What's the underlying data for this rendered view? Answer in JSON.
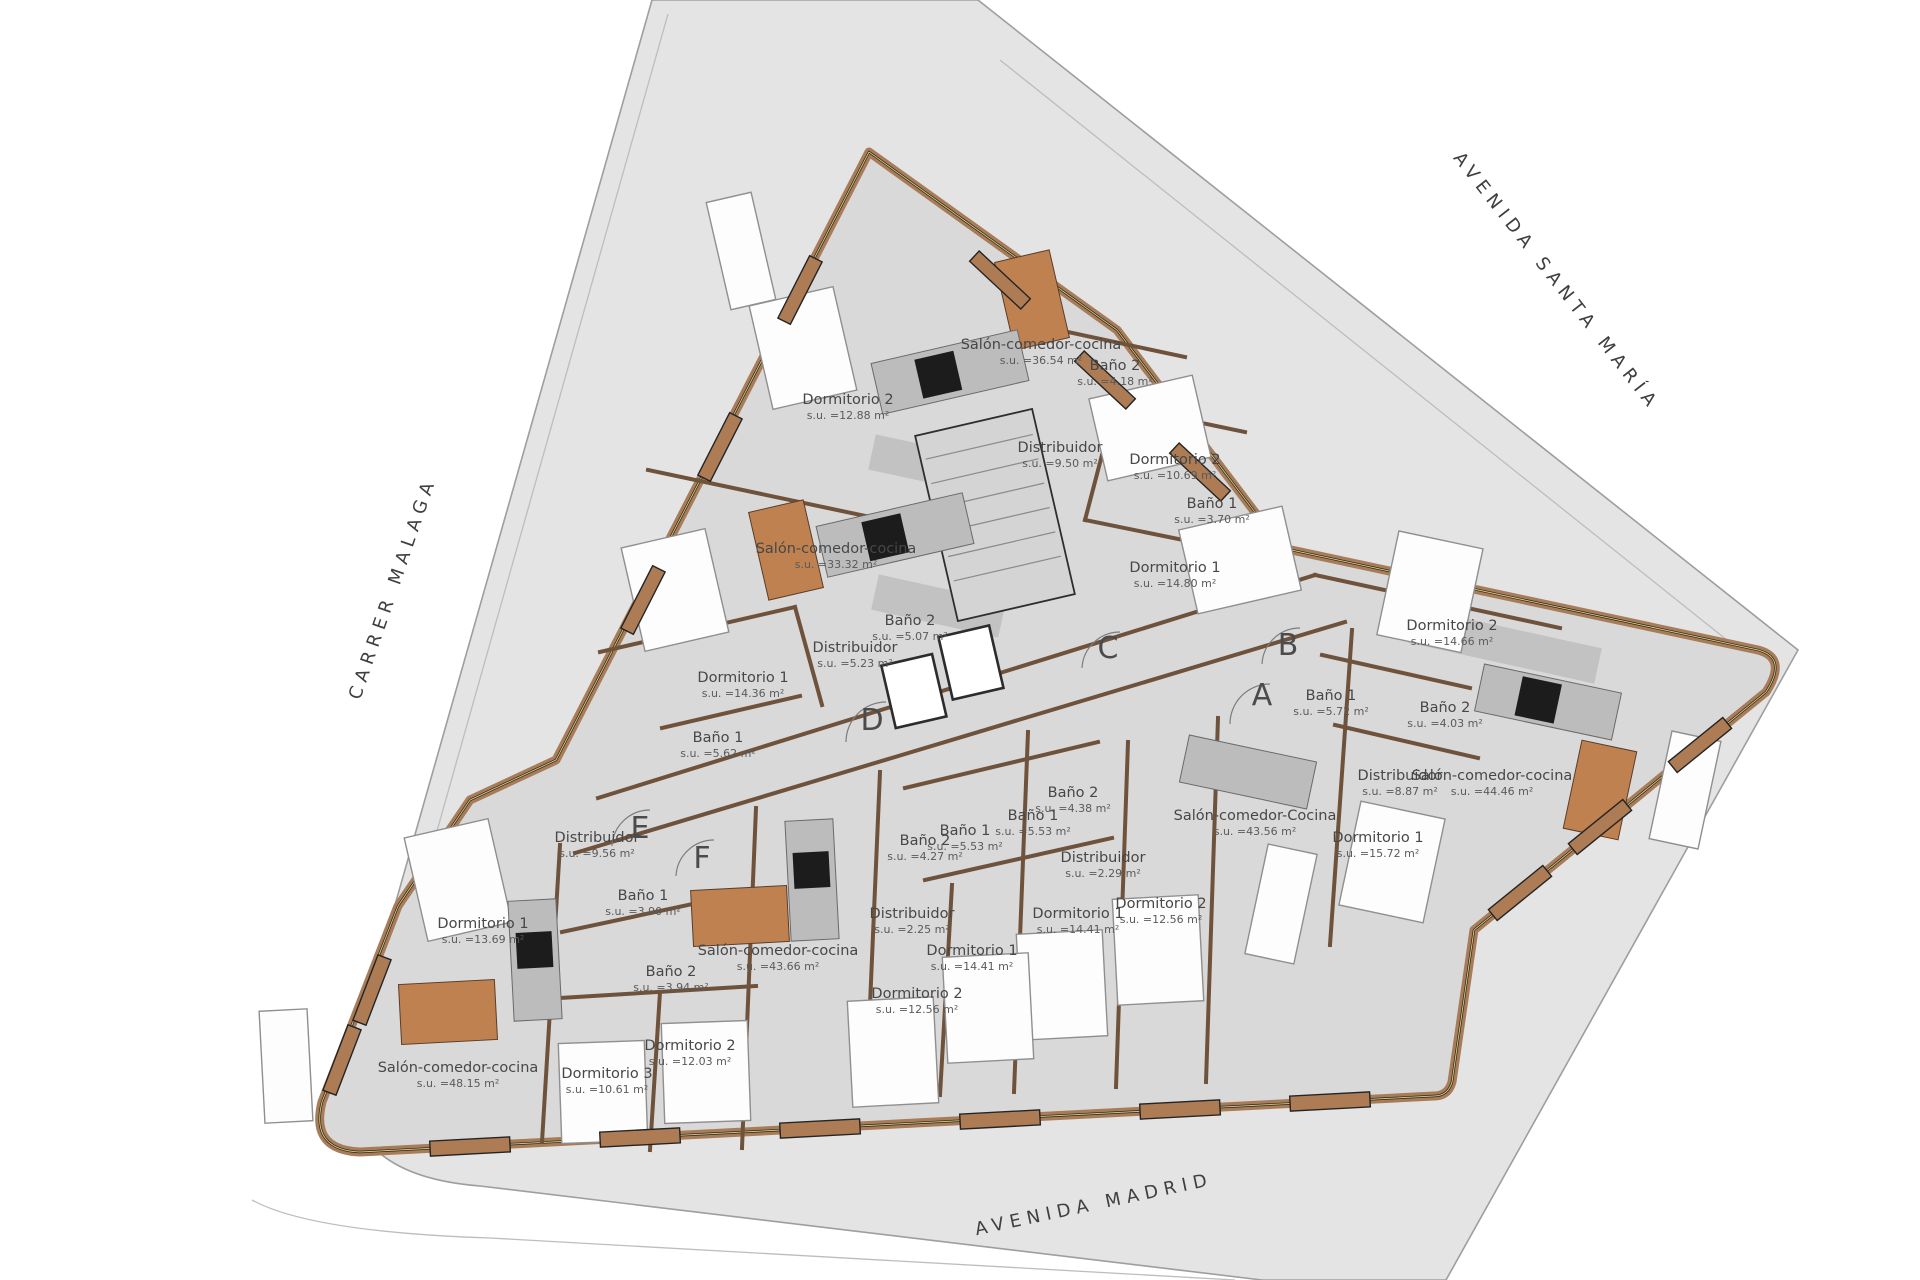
{
  "plan": {
    "title": "apartment-building-floor-plan",
    "area_prefix": "s.u. =",
    "area_unit": "m²"
  },
  "colors": {
    "site_gray": "#e4e4e4",
    "floor_gray": "#d9d9d9",
    "wall_brown": "#a87c58",
    "wall_edge": "#232323",
    "table_wood": "#bf8150",
    "counter_gray": "#bcbcbc",
    "label_text": "#474747"
  },
  "streets": [
    {
      "name": "CARRER MALAGA",
      "x": 398,
      "y": 590,
      "rotation": -71
    },
    {
      "name": "AVENIDA SANTA MARÍA",
      "x": 1552,
      "y": 285,
      "rotation": 52
    },
    {
      "name": "AVENIDA MADRID",
      "x": 1095,
      "y": 1210,
      "rotation": -12
    }
  ],
  "units": [
    {
      "letter": "A",
      "x": 1262,
      "y": 705
    },
    {
      "letter": "B",
      "x": 1288,
      "y": 655
    },
    {
      "letter": "C",
      "x": 1108,
      "y": 658
    },
    {
      "letter": "D",
      "x": 872,
      "y": 730
    },
    {
      "letter": "E",
      "x": 640,
      "y": 838
    },
    {
      "letter": "F",
      "x": 702,
      "y": 868
    }
  ],
  "rooms": [
    {
      "name": "Salón-comedor-cocina",
      "area": "36.54",
      "x": 1041,
      "y": 349
    },
    {
      "name": "Dormitorio 2",
      "area": "12.88",
      "x": 848,
      "y": 404
    },
    {
      "name": "Baño 2",
      "area": "4.18",
      "x": 1115,
      "y": 370
    },
    {
      "name": "Distribuidor",
      "area": "9.50",
      "x": 1060,
      "y": 452
    },
    {
      "name": "Dormitorio 2",
      "area": "10.69",
      "x": 1175,
      "y": 464
    },
    {
      "name": "Baño 1",
      "area": "3.70",
      "x": 1212,
      "y": 508
    },
    {
      "name": "Dormitorio 1",
      "area": "14.80",
      "x": 1175,
      "y": 572
    },
    {
      "name": "Salón-comedor-cocina",
      "area": "33.32",
      "x": 836,
      "y": 553
    },
    {
      "name": "Baño 2",
      "area": "5.07",
      "x": 910,
      "y": 625
    },
    {
      "name": "Distribuidor",
      "area": "5.23",
      "x": 855,
      "y": 652
    },
    {
      "name": "Dormitorio 1",
      "area": "14.36",
      "x": 743,
      "y": 682
    },
    {
      "name": "Baño 1",
      "area": "5.62",
      "x": 718,
      "y": 742
    },
    {
      "name": "Dormitorio 2",
      "area": "14.66",
      "x": 1452,
      "y": 630
    },
    {
      "name": "Baño 1",
      "area": "5.72",
      "x": 1331,
      "y": 700
    },
    {
      "name": "Baño 2",
      "area": "4.03",
      "x": 1445,
      "y": 712
    },
    {
      "name": "Distribuidor",
      "area": "8.87",
      "x": 1400,
      "y": 780
    },
    {
      "name": "Salón-comedor-cocina",
      "area": "44.46",
      "x": 1492,
      "y": 780
    },
    {
      "name": "Dormitorio 1",
      "area": "15.72",
      "x": 1378,
      "y": 842
    },
    {
      "name": "Salón-comedor-Cocina",
      "area": "43.56",
      "x": 1255,
      "y": 820
    },
    {
      "name": "Baño 2",
      "area": "4.38",
      "x": 1073,
      "y": 797
    },
    {
      "name": "Baño 1",
      "area": "5.53",
      "x": 1033,
      "y": 820
    },
    {
      "name": "Distribuidor",
      "area": "2.29",
      "x": 1103,
      "y": 862
    },
    {
      "name": "Dormitorio 1",
      "area": "14.41",
      "x": 1078,
      "y": 918
    },
    {
      "name": "Dormitorio 2",
      "area": "12.56",
      "x": 1161,
      "y": 908
    },
    {
      "name": "Distribuidor",
      "area": "9.56",
      "x": 597,
      "y": 842
    },
    {
      "name": "Baño 1",
      "area": "3.90",
      "x": 643,
      "y": 900
    },
    {
      "name": "Baño 2",
      "area": "3.94",
      "x": 671,
      "y": 976
    },
    {
      "name": "Salón-comedor-cocina",
      "area": "43.66",
      "x": 778,
      "y": 955
    },
    {
      "name": "Baño 1",
      "area": "5.53",
      "x": 965,
      "y": 835
    },
    {
      "name": "Baño 2",
      "area": "4.27",
      "x": 925,
      "y": 845
    },
    {
      "name": "Distribuidor",
      "area": "2.25",
      "x": 912,
      "y": 918
    },
    {
      "name": "Dormitorio 1",
      "area": "14.41",
      "x": 972,
      "y": 955
    },
    {
      "name": "Dormitorio 2",
      "area": "12.56",
      "x": 917,
      "y": 998
    },
    {
      "name": "Dormitorio 1",
      "area": "13.69",
      "x": 483,
      "y": 928
    },
    {
      "name": "Dormitorio 2",
      "area": "12.03",
      "x": 690,
      "y": 1050
    },
    {
      "name": "Dormitorio 3",
      "area": "10.61",
      "x": 607,
      "y": 1078
    },
    {
      "name": "Salón-comedor-cocina",
      "area": "48.15",
      "x": 458,
      "y": 1072
    }
  ]
}
